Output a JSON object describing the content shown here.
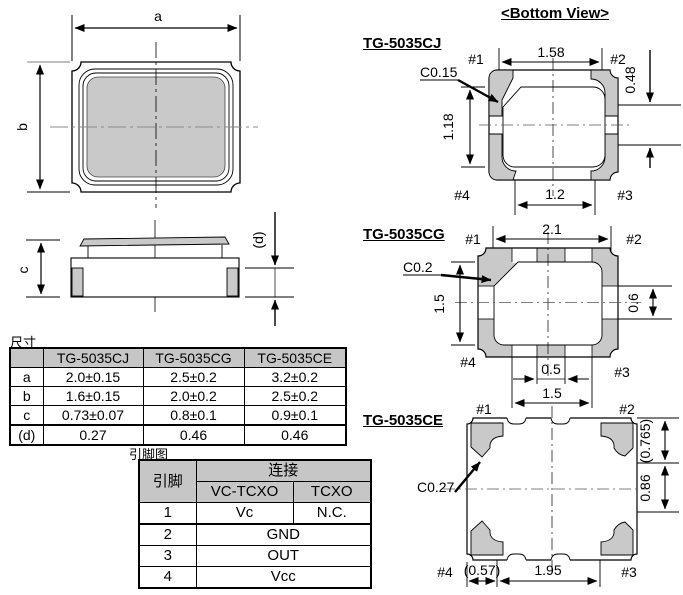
{
  "colors": {
    "pad_gray": "#c9c9c9",
    "header_gray": "#c6c6c6",
    "line": "#000000"
  },
  "top_view": {
    "dim_a": "a",
    "dim_b": "b"
  },
  "side_view": {
    "dim_c": "c",
    "dim_d": "(d)"
  },
  "dim_table": {
    "title": "尺寸",
    "columns": [
      "",
      "TG-5035CJ",
      "TG-5035CG",
      "TG-5035CE"
    ],
    "rows": [
      {
        "label": "a",
        "values": [
          "2.0±0.15",
          "2.5±0.2",
          "3.2±0.2"
        ]
      },
      {
        "label": "b",
        "values": [
          "1.6±0.15",
          "2.0±0.2",
          "2.5±0.2"
        ]
      },
      {
        "label": "c",
        "values": [
          "0.73±0.07",
          "0.8±0.1",
          "0.9±0.1"
        ]
      },
      {
        "label": "(d)",
        "values": [
          "0.27",
          "0.46",
          "0.46"
        ]
      }
    ]
  },
  "pin_table": {
    "title": "引脚图",
    "pin_header": "引脚",
    "connection_header": "连接",
    "col_vctcxo": "VC-TCXO",
    "col_tcxo": "TCXO",
    "rows": [
      {
        "pin": "1",
        "vctcxo": "Vc",
        "tcxo": "N.C."
      },
      {
        "pin": "2",
        "all": "GND"
      },
      {
        "pin": "3",
        "all": "OUT"
      },
      {
        "pin": "4",
        "all": "Vcc"
      }
    ]
  },
  "bottom_view": {
    "title": "<Bottom View>",
    "cj": {
      "label": "TG-5035CJ",
      "chamfer": "C0.15",
      "dim_top": "1.58",
      "dim_left": "1.18",
      "dim_right": "0.48",
      "dim_bottom": "1.2",
      "p1": "#1",
      "p2": "#2",
      "p3": "#3",
      "p4": "#4"
    },
    "cg": {
      "label": "TG-5035CG",
      "chamfer": "C0.2",
      "dim_top": "2.1",
      "dim_left": "1.5",
      "dim_right": "0.6",
      "dim_bottom_center": "0.5",
      "dim_bottom": "1.5",
      "p1": "#1",
      "p2": "#2",
      "p3": "#3",
      "p4": "#4"
    },
    "ce": {
      "label": "TG-5035CE",
      "chamfer": "C0.27",
      "dim_right_top": "(0.765)",
      "dim_right_bottom": "0.86",
      "dim_bottom_left": "(0.57)",
      "dim_bottom": "1.95",
      "p1": "#1",
      "p2": "#2",
      "p3": "#3",
      "p4": "#4"
    }
  }
}
